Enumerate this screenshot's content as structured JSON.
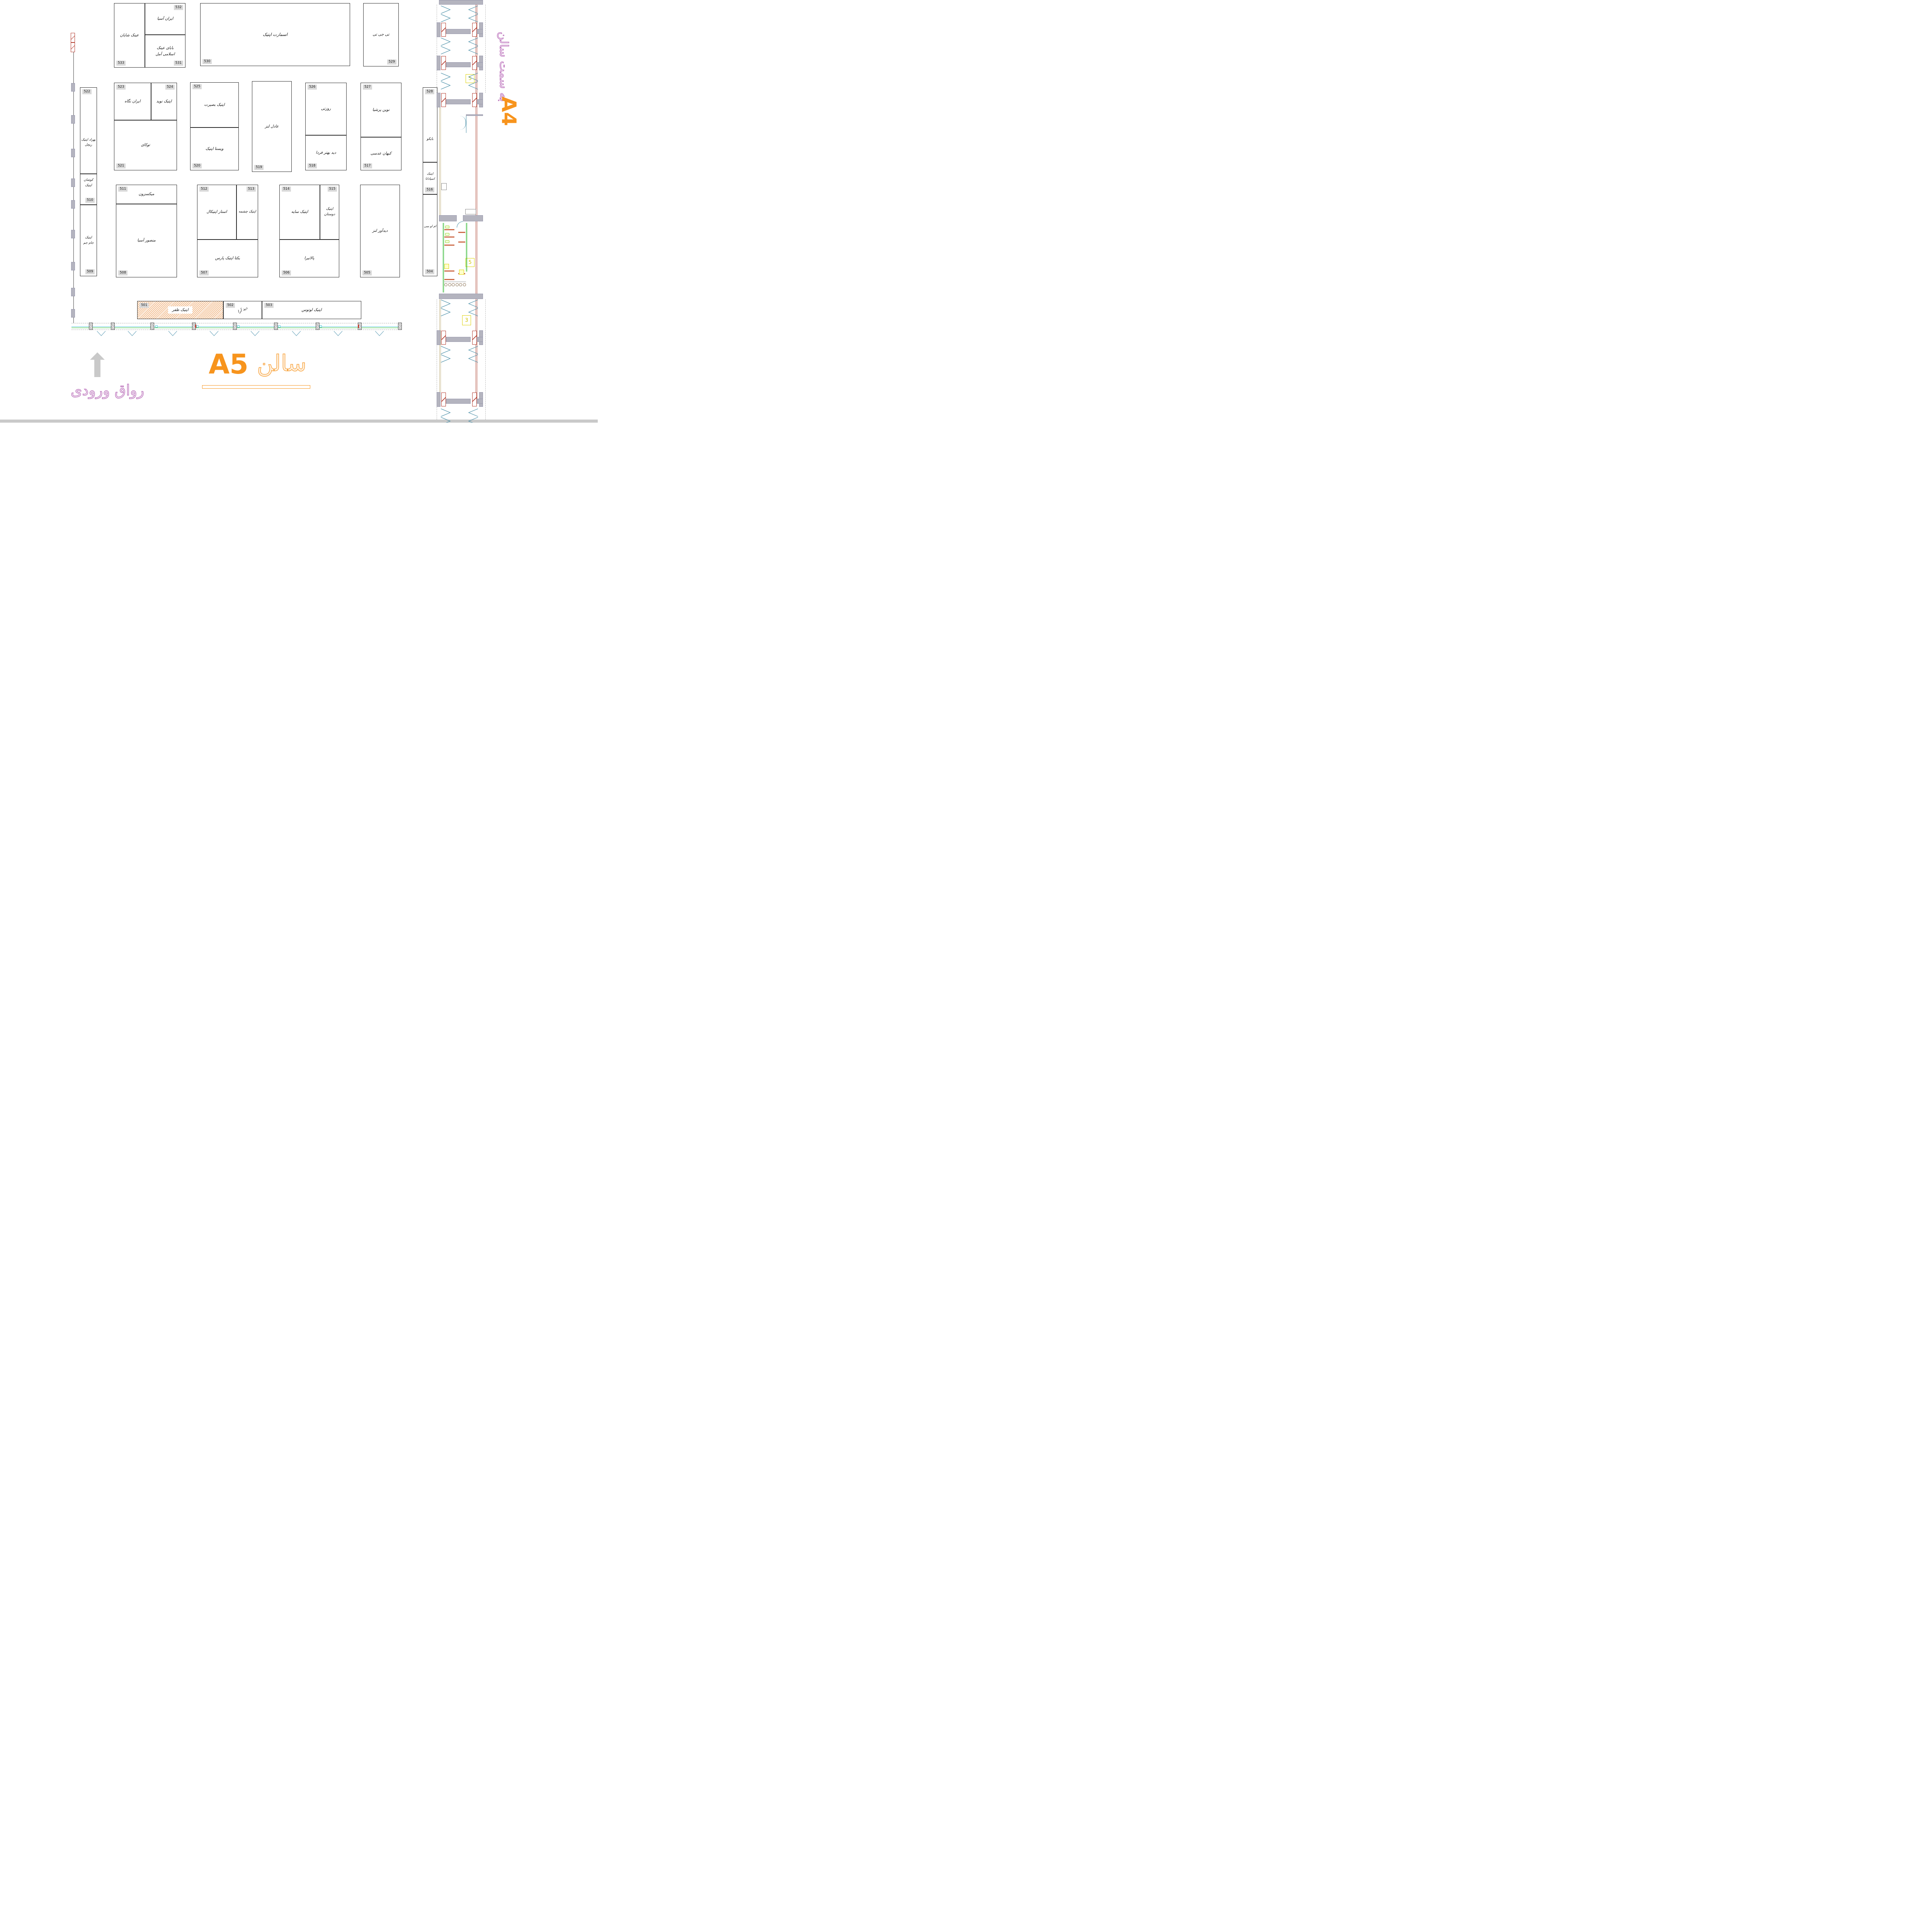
{
  "hall": {
    "code": "A5",
    "name": "سالن"
  },
  "adjacent": {
    "label": "به سمت سالن",
    "code": "A4"
  },
  "entrance": {
    "label": "رواق ورودی"
  },
  "corridor": {
    "room_a": "5",
    "room_b": "5",
    "room_c": "3"
  },
  "booths": {
    "b501": {
      "number": "501",
      "name": "اپتیک ظفر"
    },
    "b502": {
      "number": "502",
      "name": "دید آرا"
    },
    "b503": {
      "number": "503",
      "name": "اپتیک لوتوس"
    },
    "b504": {
      "number": "504",
      "name": "ام او سی"
    },
    "b505": {
      "number": "505",
      "name": "دیدآور لنز"
    },
    "b506": {
      "number": "506",
      "name": "پالانیرا"
    },
    "b507": {
      "number": "507",
      "name": "یکتا اپتیک پارس"
    },
    "b508": {
      "number": "508",
      "name": "منصور آسیا"
    },
    "b509": {
      "number": "509",
      "name": "اپتیک\nجام جم"
    },
    "b510": {
      "number": "510",
      "name": "کوشان\nاپتیک"
    },
    "b511": {
      "number": "511",
      "name": "میکسزون"
    },
    "b512": {
      "number": "512",
      "name": "استار اپتیکال"
    },
    "b513": {
      "number": "513",
      "name": "اپتیک چشمه"
    },
    "b514": {
      "number": "514",
      "name": "اپتیک سایه"
    },
    "b515": {
      "number": "515",
      "name": "اپتیک\nدوستان"
    },
    "b516": {
      "number": "516",
      "name": "اپتیک\nاسپادانا"
    },
    "b517": {
      "number": "517",
      "name": "کیهان عدسی"
    },
    "b518": {
      "number": "518",
      "name": "دید بهتر فردا"
    },
    "b519": {
      "number": "519",
      "name": "عادل لنز"
    },
    "b520": {
      "number": "520",
      "name": "ویستا اپتیک"
    },
    "b521": {
      "number": "521",
      "name": "توکای"
    },
    "b522": {
      "number": "522",
      "name": "بهزاد اپتیک\nریچل"
    },
    "b523": {
      "number": "523",
      "name": "ایران نگاه"
    },
    "b524": {
      "number": "524",
      "name": "اپتیک نوید"
    },
    "b525": {
      "number": "525",
      "name": "اپتیک بصیرت"
    },
    "b526": {
      "number": "526",
      "name": "روزتی"
    },
    "b527": {
      "number": "527",
      "name": "نوین پرشیا"
    },
    "b528": {
      "number": "528",
      "name": "بایکو"
    },
    "b529": {
      "number": "529",
      "name": "تی جی تی"
    },
    "b530": {
      "number": "530",
      "name": "اسمارت اپتیک"
    },
    "b531": {
      "number": "531",
      "name": "بابای عینک\nاسلامی آمل"
    },
    "b532": {
      "number": "532",
      "name": "ایران آسیا"
    },
    "b533": {
      "number": "533",
      "name": "عینک شایان"
    }
  }
}
